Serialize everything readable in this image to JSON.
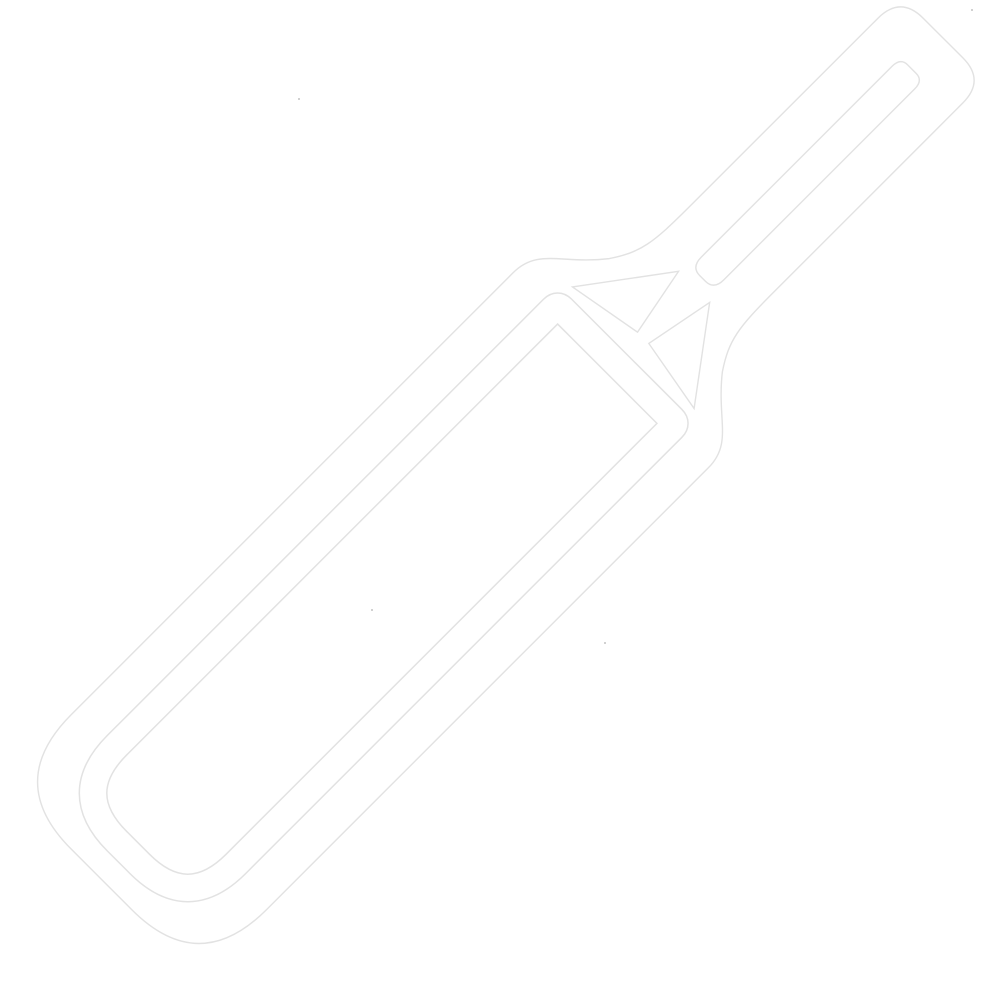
{
  "page": {
    "kind": "icon-image",
    "content": "white outline icon of a cricket bat, rotated diagonally with the handle toward the top-right and the blade toward the bottom-left, drawn white-on-white with faint light-gray anti-aliased edges"
  },
  "icon": {
    "name": "cricket-bat-icon",
    "parts": [
      "handle",
      "handle-hollow",
      "splice-v-cutouts",
      "shoulders",
      "blade",
      "inner-face-outline",
      "rounded-toe"
    ]
  },
  "colors": {
    "background": "#ffffff",
    "icon": "#ffffff",
    "edge": "#e2e2e2",
    "speck": "#ababab"
  }
}
